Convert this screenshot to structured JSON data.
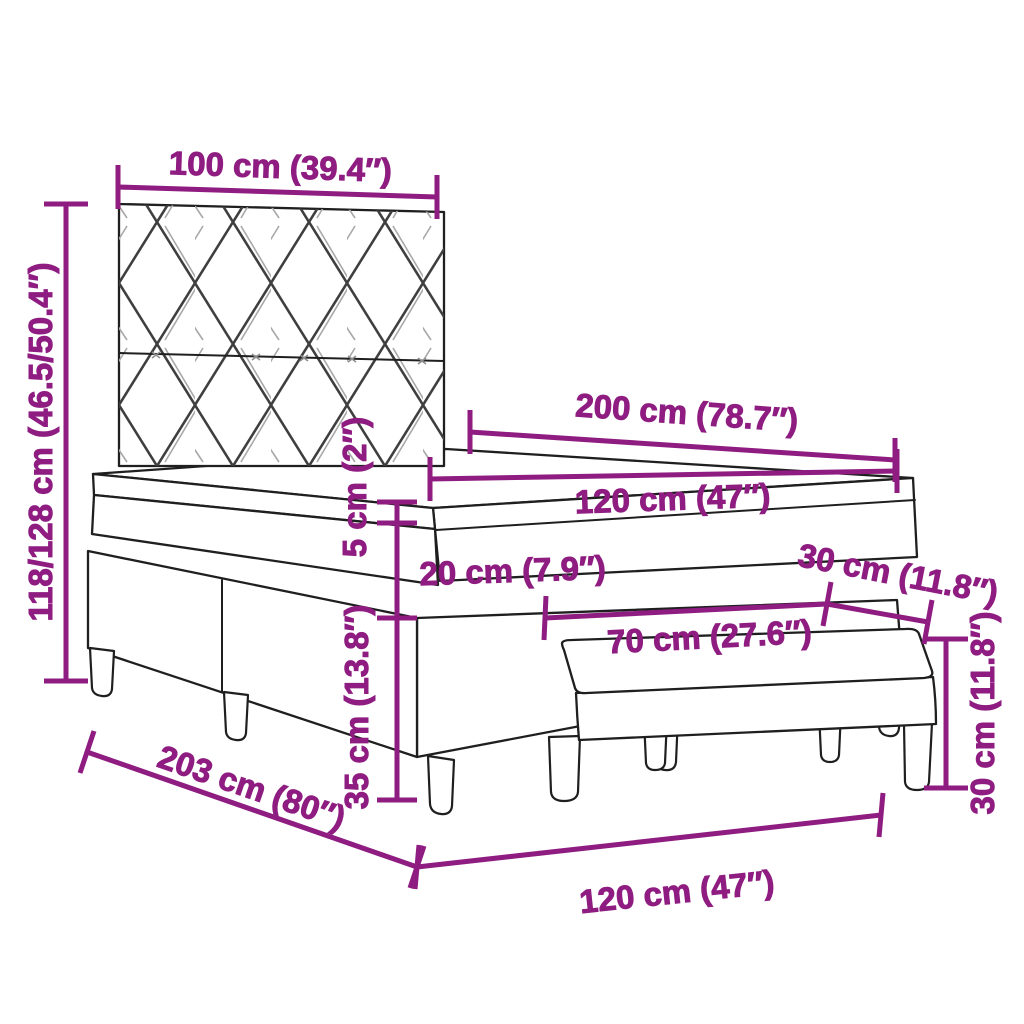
{
  "diagram_type": "furniture-dimension-diagram",
  "subject": "box-spring-bed-with-headboard-and-bench",
  "background_color": "#ffffff",
  "colors": {
    "dimension_purple": "#8E1C81",
    "outline_black": "#1f1f1f",
    "pattern_gray": "#3f3f3f"
  },
  "dimensions": {
    "headboard_width": "100 cm (39.4″)",
    "headboard_height": "118/128 cm (46.5/50.4″)",
    "bed_length": "200 cm (78.7″)",
    "mattress_width": "120 cm (47″)",
    "topper_thickness": "5 cm (2″)",
    "mattress_thickness": "20 cm (7.9″)",
    "bench_depth": "30 cm (11.8″)",
    "bench_length": "70 cm (27.6″)",
    "base_height": "35 cm (13.8″)",
    "bench_height": "30 cm (11.8″)",
    "frame_length": "203 cm (80″)",
    "bed_width": "120 cm (47″)"
  }
}
